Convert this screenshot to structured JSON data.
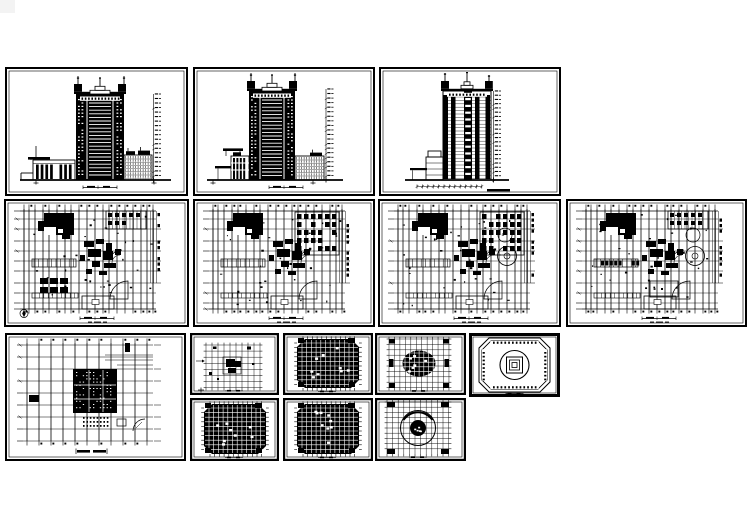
{
  "canvas": {
    "width": 749,
    "height": 530,
    "paper": "#ffffff",
    "ink": "#000000"
  },
  "artifact": {
    "x": 0,
    "y": 0,
    "w": 15,
    "h": 13,
    "color": "#f3f3f3"
  },
  "sheets": [
    {
      "id": "elev-front",
      "name": "front-elevation",
      "type": "elevation_front",
      "x": 5,
      "y": 67,
      "w": 183,
      "h": 129,
      "seed": 11
    },
    {
      "id": "elev-rear",
      "name": "rear-elevation",
      "type": "elevation_rear",
      "x": 193,
      "y": 67,
      "w": 182,
      "h": 129,
      "seed": 22
    },
    {
      "id": "elev-side",
      "name": "side-elevation",
      "type": "elevation_side",
      "x": 379,
      "y": 67,
      "w": 182,
      "h": 129,
      "seed": 33
    },
    {
      "id": "plan-1",
      "name": "ground-floor-plan",
      "type": "plan_podium",
      "x": 4,
      "y": 199,
      "w": 185,
      "h": 128,
      "seed": 44,
      "variant": {
        "furniture": "bottom-left",
        "topRight": "hatch",
        "compass": true,
        "circles": false,
        "bandCells": false
      }
    },
    {
      "id": "plan-2",
      "name": "second-floor-plan",
      "type": "plan_podium",
      "x": 193,
      "y": 199,
      "w": 182,
      "h": 128,
      "seed": 55,
      "variant": {
        "furniture": "top-right",
        "topRight": "grid",
        "compass": false,
        "circles": false,
        "bandCells": false
      }
    },
    {
      "id": "plan-3",
      "name": "third-floor-plan",
      "type": "plan_podium",
      "x": 378,
      "y": 199,
      "w": 183,
      "h": 128,
      "seed": 66,
      "variant": {
        "furniture": "top-right",
        "topRight": "grid",
        "compass": false,
        "circles": true,
        "bandCells": false
      }
    },
    {
      "id": "plan-4",
      "name": "fourth-floor-plan",
      "type": "plan_podium",
      "x": 566,
      "y": 199,
      "w": 181,
      "h": 128,
      "seed": 77,
      "variant": {
        "furniture": "none",
        "topRight": "hatch",
        "compass": false,
        "circles": true,
        "bandCells": true
      }
    },
    {
      "id": "plan-5",
      "name": "podium-roof-tower-plan",
      "type": "plan_tower",
      "x": 5,
      "y": 333,
      "w": 181,
      "h": 128,
      "seed": 88
    },
    {
      "id": "plan-6",
      "name": "typical-plan-light",
      "type": "plan_small_light",
      "x": 190,
      "y": 333,
      "w": 89,
      "h": 62,
      "seed": 99
    },
    {
      "id": "plan-7",
      "name": "standard-floor-plan-a",
      "type": "plan_small_dense",
      "x": 283,
      "y": 333,
      "w": 90,
      "h": 62,
      "seed": 110
    },
    {
      "id": "plan-8",
      "name": "machine-room-plan",
      "type": "plan_small_ellipse",
      "x": 375,
      "y": 333,
      "w": 91,
      "h": 62,
      "seed": 121
    },
    {
      "id": "plan-9",
      "name": "roof-dome-plan",
      "type": "plan_roof",
      "x": 469,
      "y": 333,
      "w": 91,
      "h": 64,
      "seed": 132
    },
    {
      "id": "plan-10",
      "name": "standard-floor-plan-b",
      "type": "plan_small_dense",
      "x": 190,
      "y": 398,
      "w": 89,
      "h": 63,
      "seed": 143
    },
    {
      "id": "plan-11",
      "name": "standard-floor-plan-c",
      "type": "plan_small_dense",
      "x": 283,
      "y": 398,
      "w": 90,
      "h": 63,
      "seed": 154
    },
    {
      "id": "plan-12",
      "name": "top-floor-circle-plan",
      "type": "plan_small_circle",
      "x": 375,
      "y": 398,
      "w": 91,
      "h": 63,
      "seed": 165
    }
  ]
}
